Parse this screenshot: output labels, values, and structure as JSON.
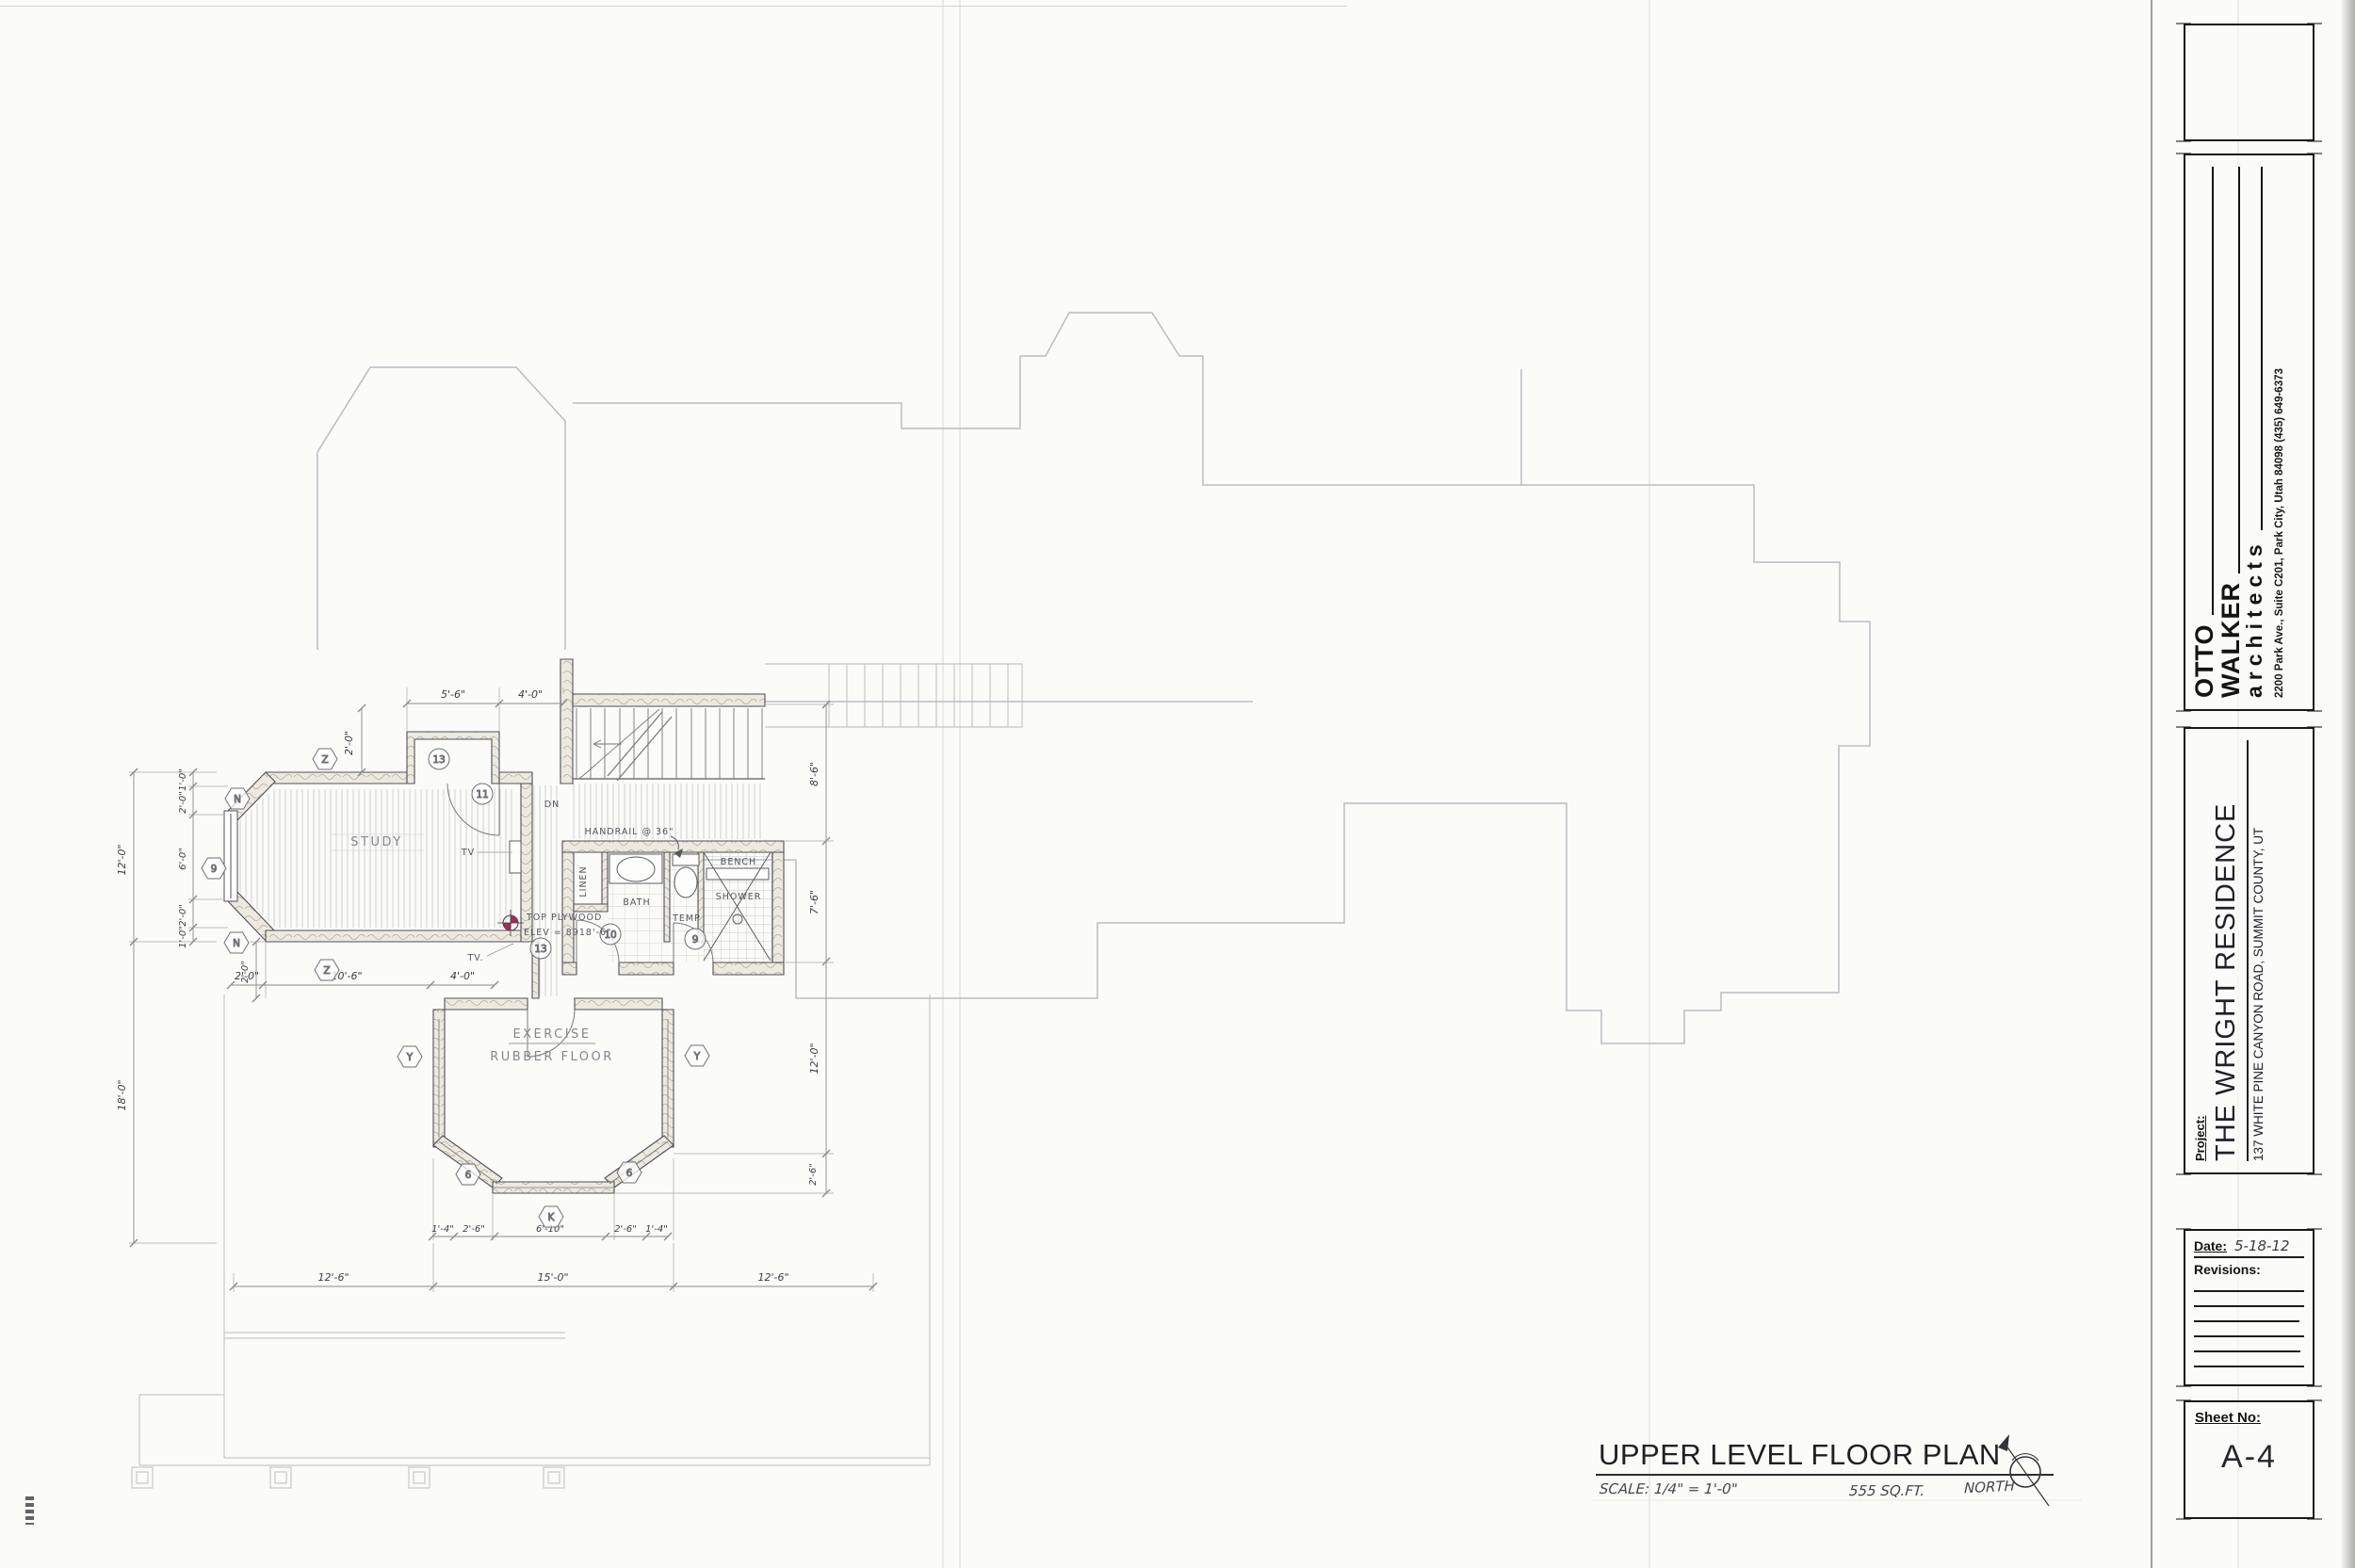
{
  "sheet": {
    "title": "UPPER LEVEL FLOOR PLAN",
    "scale": "SCALE: 1/4\" = 1'-0\"",
    "area": "555 SQ.FT.",
    "north": "NORTH"
  },
  "title_block": {
    "firm_line1": "OTTO",
    "firm_line2": "WALKER",
    "firm_line3": "architects",
    "firm_address": "2200 Park Ave., Suite C201, Park City, Utah 84098    (435) 649-6373",
    "project_label": "Project:",
    "project_name": "THE WRIGHT RESIDENCE",
    "project_address": "137 WHITE PINE CANYON ROAD, SUMMIT COUNTY, UT",
    "date_label": "Date:",
    "date_value": "5-18-12",
    "revisions_label": "Revisions:",
    "sheet_no_label": "Sheet No:",
    "sheet_no_value": "A-4"
  },
  "plan": {
    "rooms": {
      "study": "STUDY",
      "exercise1": "EXERCISE",
      "exercise2": "RUBBER FLOOR",
      "bath": "BATH"
    },
    "fixtures": {
      "linen": "LINEN",
      "temp": "TEMP",
      "bench": "BENCH",
      "shower": "SHOWER"
    },
    "notes": {
      "tv": "TV",
      "tv2": "TV.",
      "dn": "DN",
      "handrail": "HANDRAIL @ 36\"",
      "elev1": "TOP PLYWOOD",
      "elev2": "ELEV = 8918'-6\""
    },
    "keynotes_hex": [
      "Z",
      "N",
      "9",
      "N",
      "Z",
      "Y",
      "Y",
      "6",
      "6",
      "K"
    ],
    "keynotes_circle": [
      "13",
      "11",
      "10",
      "9",
      "13"
    ],
    "dims": {
      "top": [
        "5'-6\"",
        "4'-0\"",
        "2'-0\""
      ],
      "left_overall": [
        "12'-0\"",
        "18'-0\""
      ],
      "left_sub": [
        "1'-0\"",
        "2'-0\"",
        "6'-0\"",
        "2'-0\"",
        "1'-0\""
      ],
      "left_mid": "2'-0\"",
      "study_bottom": [
        "2'-0\"",
        "10'-6\"",
        "4'-0\""
      ],
      "right": [
        "8'-6\"",
        "7'-6\"",
        "12'-0\"",
        "2'-6\""
      ],
      "bay": [
        "1'-4\"",
        "2'-6\"",
        "6'-10\"",
        "2'-6\"",
        "1'-4\""
      ],
      "bottom": [
        "12'-6\"",
        "15'-0\"",
        "12'-6\""
      ]
    }
  }
}
